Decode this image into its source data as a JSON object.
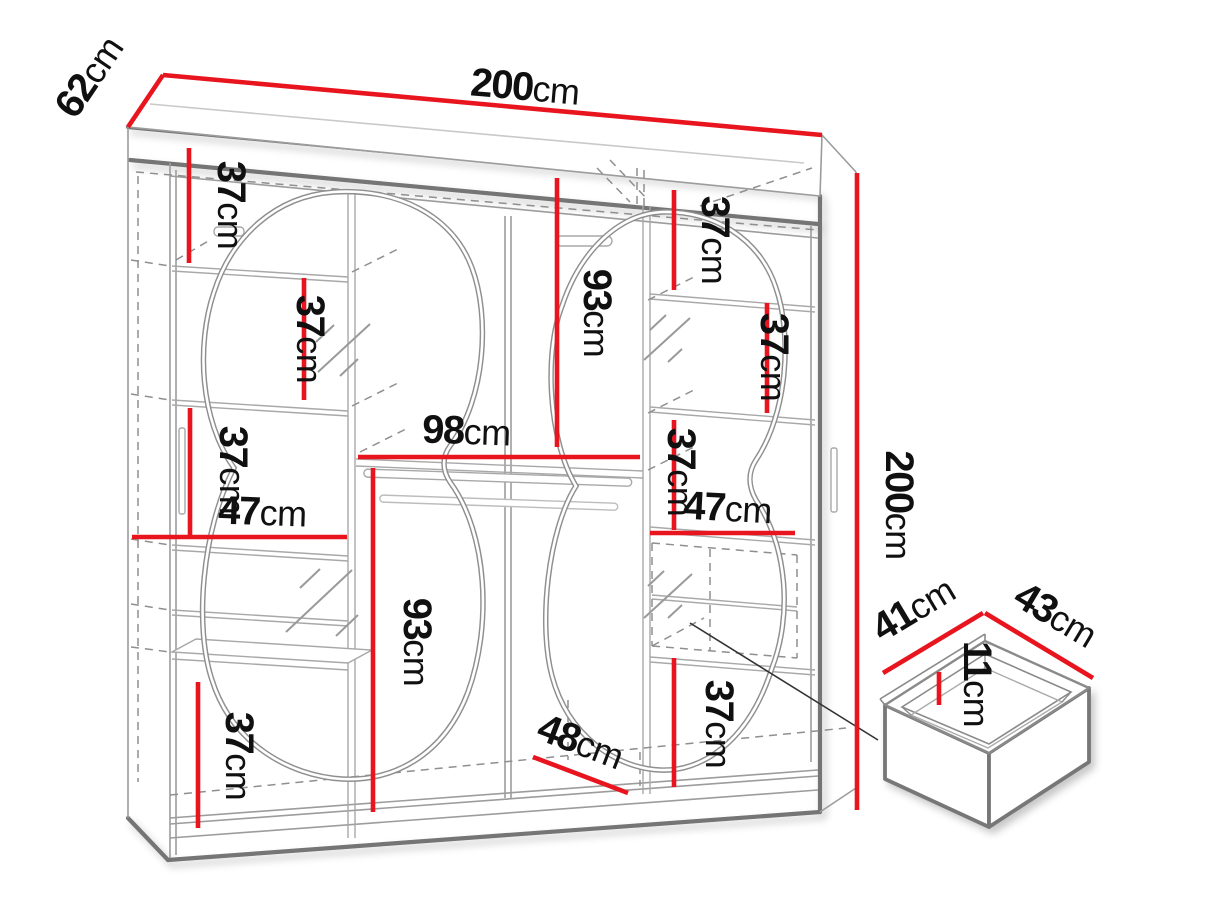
{
  "colors": {
    "dimension_red": "#e8141e",
    "outline_gray": "#747474",
    "thin_gray": "#9c9c9c",
    "dash_gray": "#8f8f8f",
    "text_black": "#101010",
    "background": "#ffffff"
  },
  "labels": [
    {
      "id": "depth-top",
      "value": "62",
      "unit": "cm"
    },
    {
      "id": "width-top",
      "value": "200",
      "unit": "cm"
    },
    {
      "id": "left-top-gap",
      "value": "37",
      "unit": "cm"
    },
    {
      "id": "left-shelf-gap-2",
      "value": "37",
      "unit": "cm"
    },
    {
      "id": "right-top-gap",
      "value": "37",
      "unit": "cm"
    },
    {
      "id": "center-upper-height",
      "value": "93",
      "unit": "cm"
    },
    {
      "id": "right-shelf-gap-2",
      "value": "37",
      "unit": "cm"
    },
    {
      "id": "center-width",
      "value": "98",
      "unit": "cm"
    },
    {
      "id": "left-shelf-gap-3",
      "value": "37",
      "unit": "cm"
    },
    {
      "id": "left-shelf-width",
      "value": "47",
      "unit": "cm"
    },
    {
      "id": "right-shelf-gap-3",
      "value": "37",
      "unit": "cm"
    },
    {
      "id": "right-shelf-width",
      "value": "47",
      "unit": "cm"
    },
    {
      "id": "left-lower-height",
      "value": "93",
      "unit": "cm"
    },
    {
      "id": "right-bottom-gap",
      "value": "37",
      "unit": "cm"
    },
    {
      "id": "left-bottom-gap",
      "value": "37",
      "unit": "cm"
    },
    {
      "id": "bottom-depth",
      "value": "48",
      "unit": "cm"
    },
    {
      "id": "height-right",
      "value": "200",
      "unit": "cm"
    },
    {
      "id": "drawer-width",
      "value": "41",
      "unit": "cm"
    },
    {
      "id": "drawer-depth",
      "value": "43",
      "unit": "cm"
    },
    {
      "id": "drawer-height",
      "value": "11",
      "unit": "cm"
    }
  ]
}
